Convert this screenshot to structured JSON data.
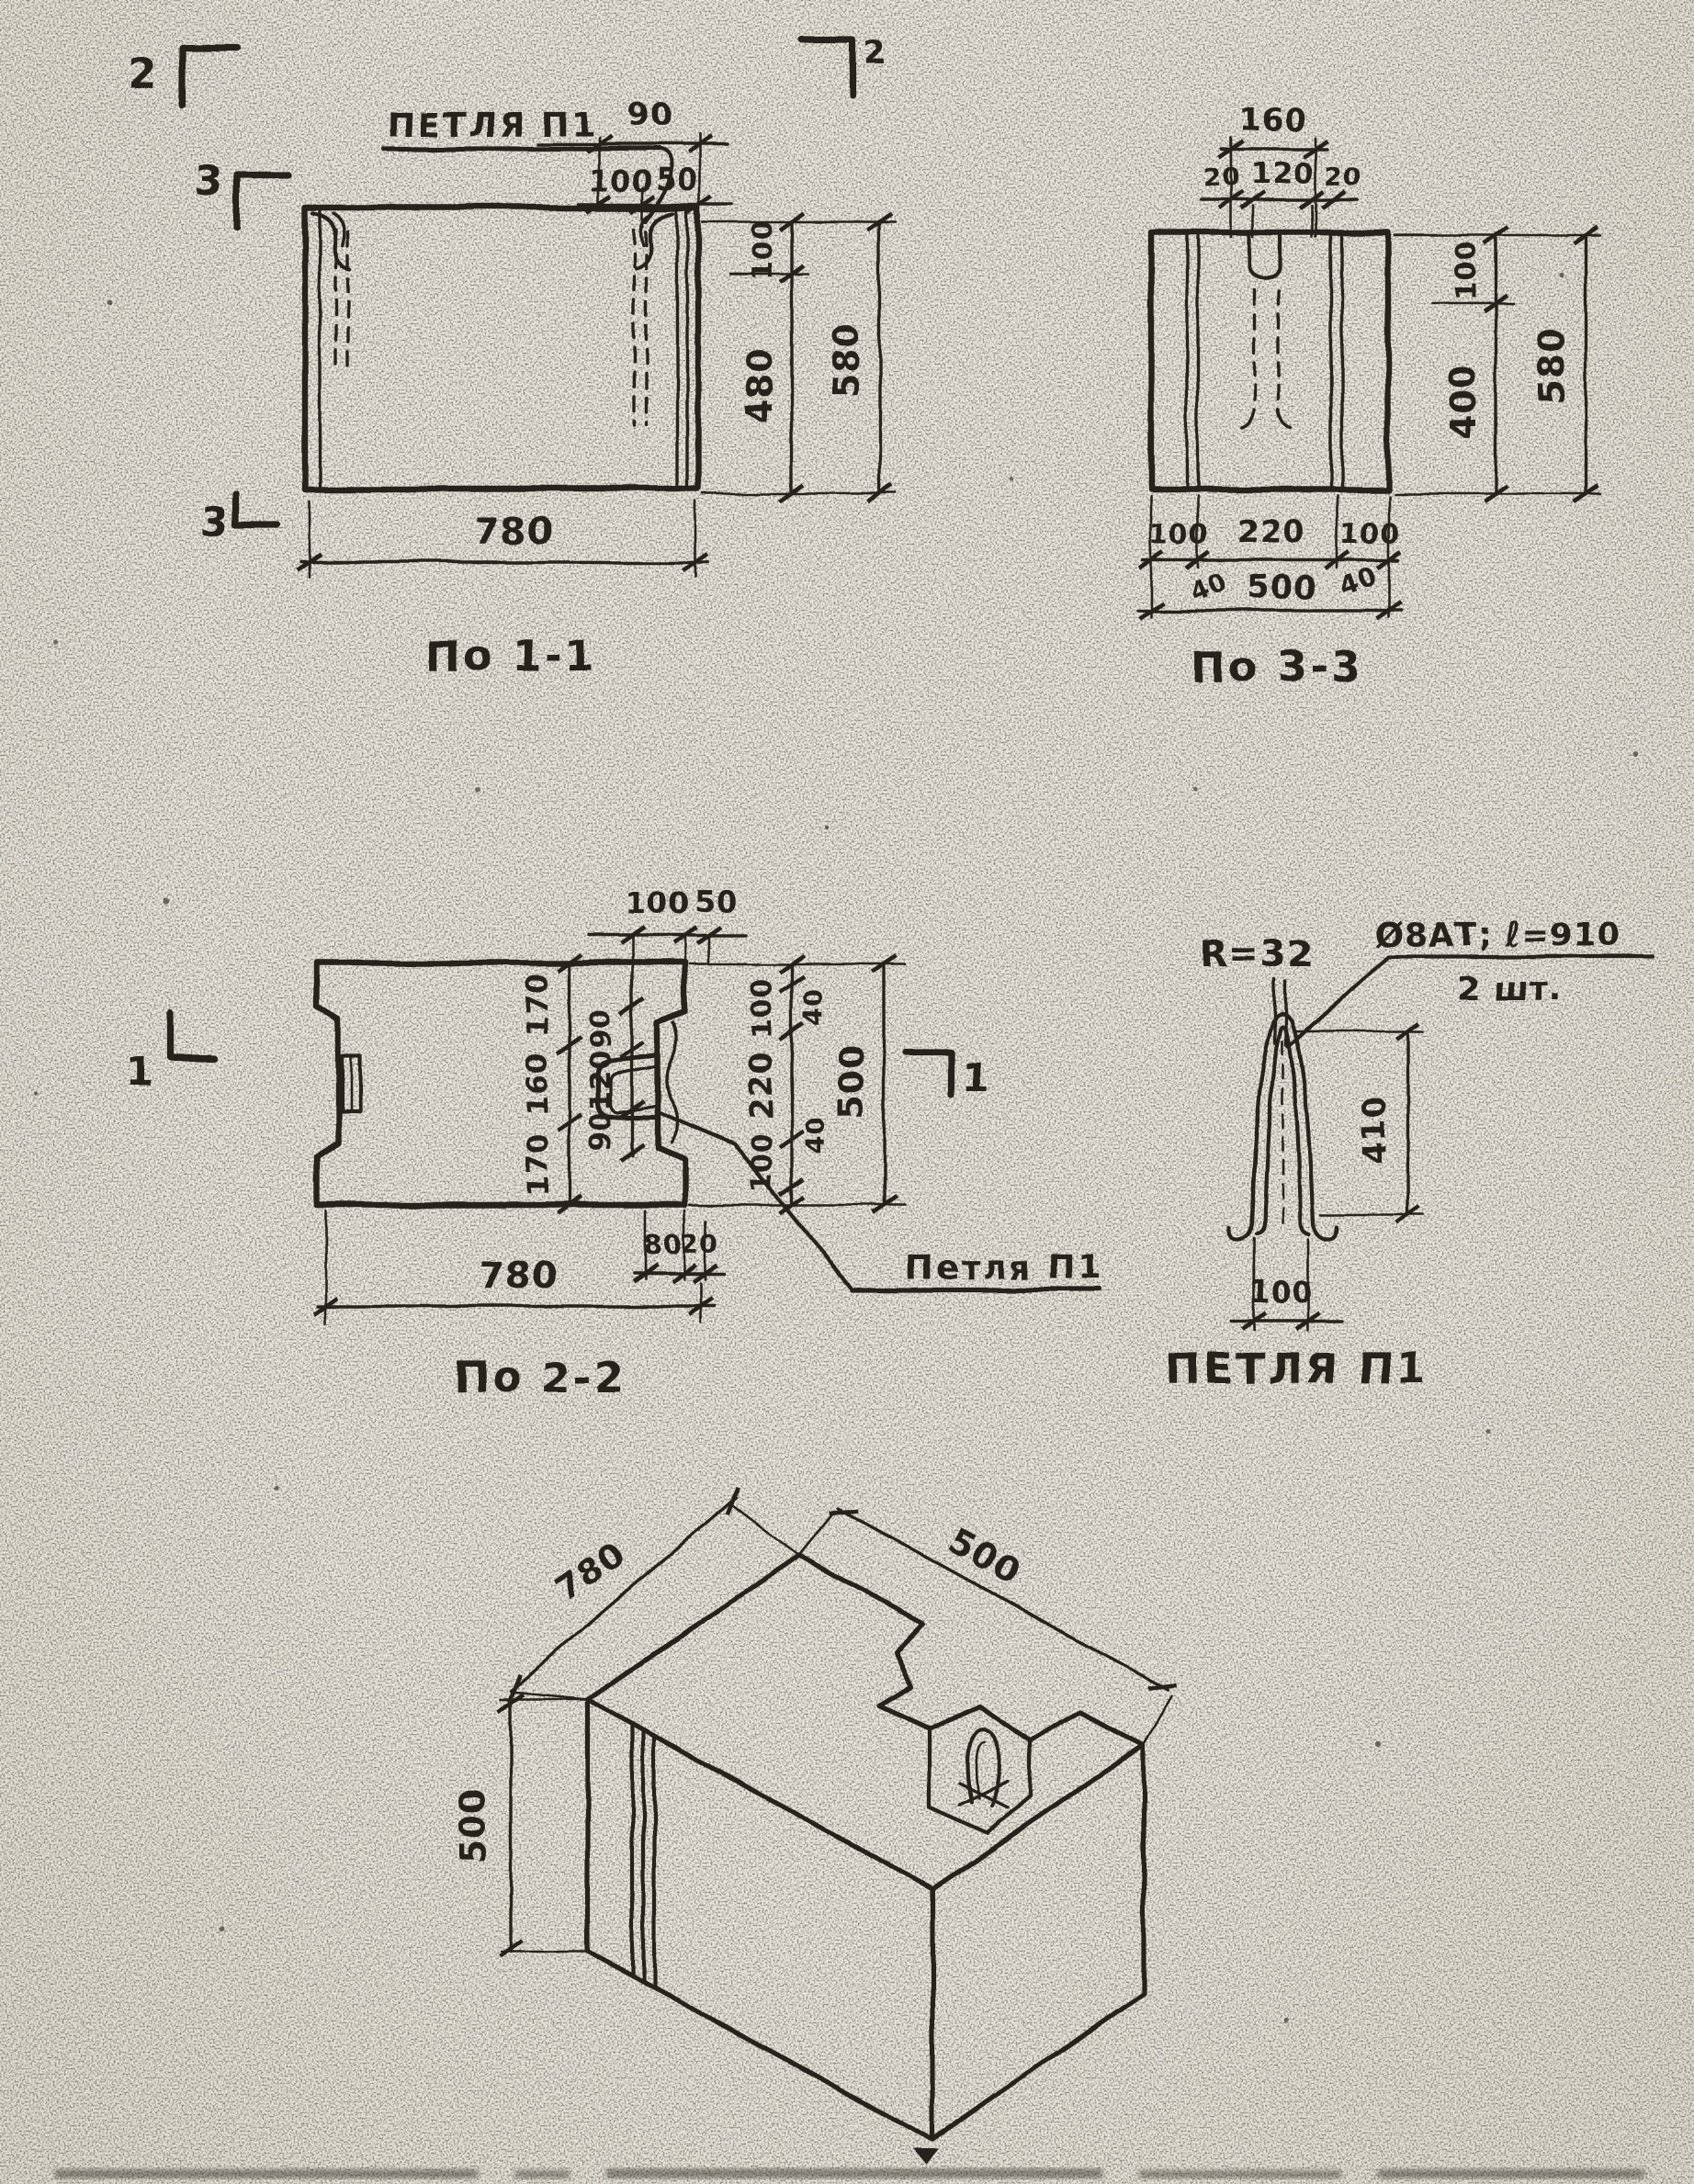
{
  "paper": {
    "bg": "#eae7df",
    "ink": "#27221b"
  },
  "marks": {
    "s2a": "2",
    "s2b": "2",
    "s3a": "3",
    "s3b": "3",
    "s1a": "1",
    "s1b": "1"
  },
  "view11": {
    "caption": "По 1-1",
    "loop_label": "ПЕТЛЯ П1",
    "dim_90": "90",
    "dim_100t": "100",
    "dim_50": "50",
    "dim_100r": "100",
    "dim_480": "480",
    "dim_580": "580",
    "dim_780": "780"
  },
  "view33": {
    "caption": "По 3-3",
    "dim_160": "160",
    "dim_20l": "20",
    "dim_120": "120",
    "dim_20r": "20",
    "dim_100r": "100",
    "dim_400": "400",
    "dim_580": "580",
    "dim_100bl": "100",
    "dim_220": "220",
    "dim_100br": "100",
    "dim_40l": "40",
    "dim_40r": "40",
    "dim_500": "500"
  },
  "view22": {
    "caption": "По 2-2",
    "loop_label": "Петля П1",
    "dim_100t": "100",
    "dim_50t": "50",
    "col_170a": "170",
    "col_160": "160",
    "col_170b": "170",
    "col_90a": "90",
    "col_120": "120",
    "col_90b": "90",
    "dim_100ra": "100",
    "dim_220r": "220",
    "dim_100rb": "100",
    "dim_40a": "40",
    "dim_40b": "40",
    "dim_500": "500",
    "dim_80": "80",
    "dim_20": "20",
    "dim_780": "780"
  },
  "loop_detail": {
    "caption": "ПЕТЛЯ П1",
    "radius_label": "R=32",
    "spec": "Ø8АТ; ℓ=910",
    "qty": "2 шт.",
    "dim_410": "410",
    "dim_100": "100"
  },
  "iso": {
    "dim_780": "780",
    "dim_500w": "500",
    "dim_500h": "500"
  }
}
